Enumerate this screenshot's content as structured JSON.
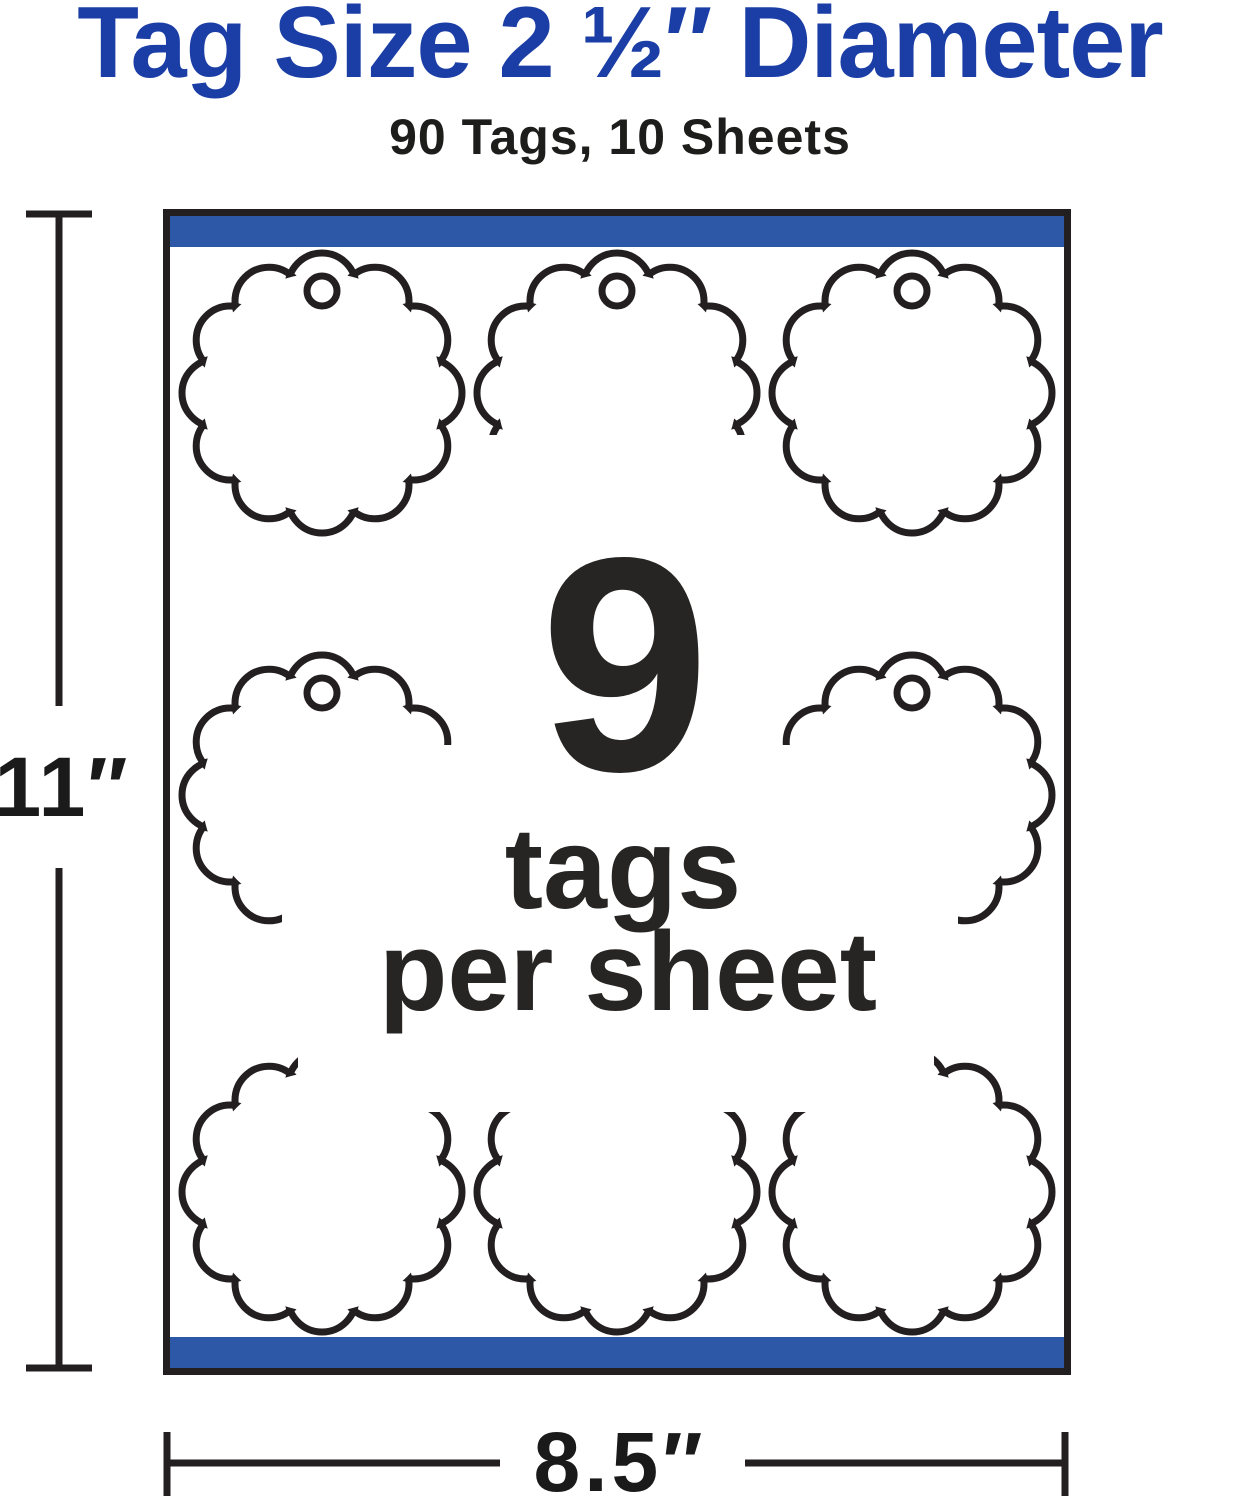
{
  "title": "Tag Size 2 ½″ Diameter",
  "subtitle": "90 Tags, 10 Sheets",
  "sheet_preview": {
    "center_count": "9",
    "center_unit": "tags",
    "center_per": "per sheet",
    "height_label": "11″",
    "width_label": "8.5″",
    "tags_per_sheet": 9,
    "grid_rows": 3,
    "grid_columns": 3
  },
  "colors": {
    "title_blue": "#1b3ea6",
    "bar_blue": "#2d57a7",
    "ink": "#231f20",
    "text_dark": "#272523"
  }
}
